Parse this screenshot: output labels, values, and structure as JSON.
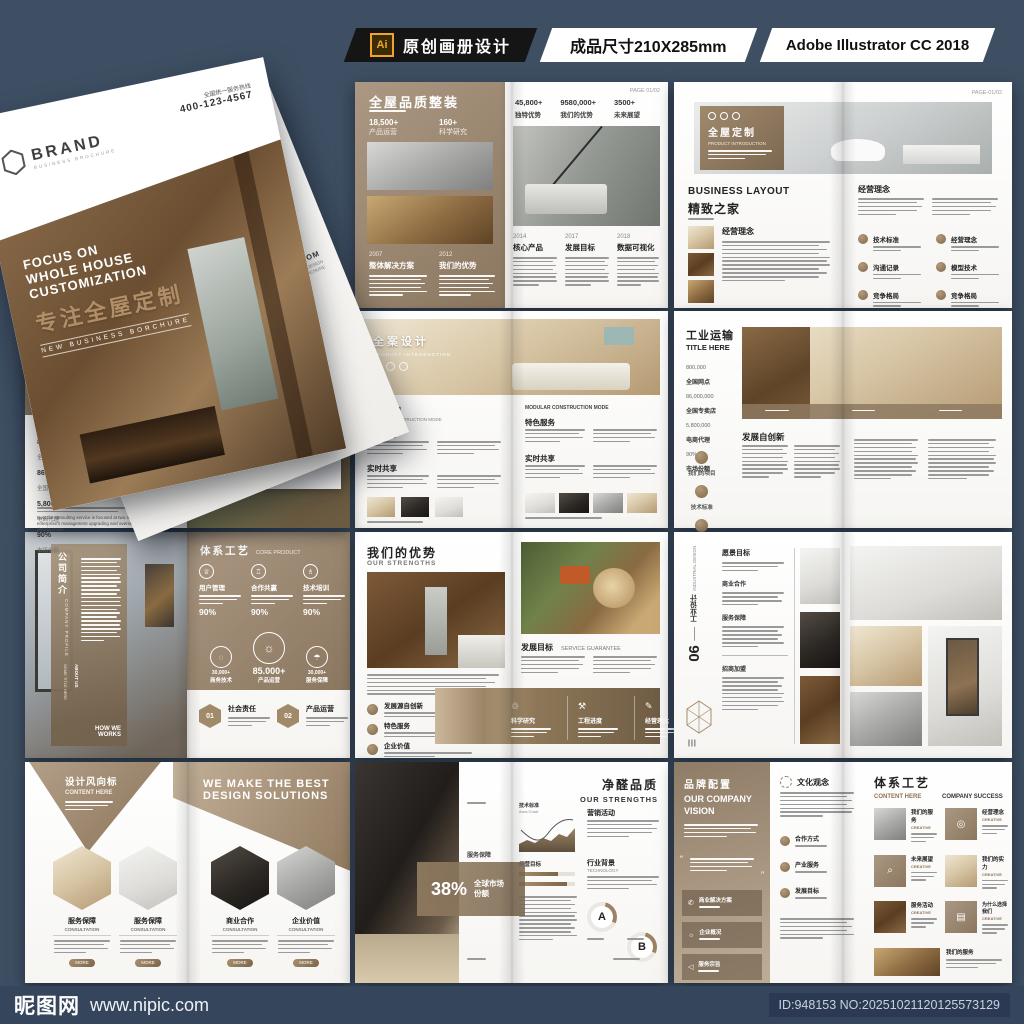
{
  "header": {
    "ai_badge": "Ai",
    "title": "原创画册设计",
    "size": "成品尺寸210X285mm",
    "software": "Adobe Illustrator CC 2018"
  },
  "footer": {
    "site": "昵图网",
    "url": "www.nipic.com",
    "id_no": "ID:948153 NO:20251021120125573129"
  },
  "cover": {
    "hotline_label": "全国统一服务热线",
    "hotline": "400-123-4567",
    "brand": "BRAND",
    "brand_sub": "BUSINESS BROCHURE",
    "headline1": "FOCUS ON",
    "headline2": "WHOLE HOUSE",
    "headline3": "CUSTOMIZATION",
    "title_cn": "专注全屋定制",
    "tagline": "NEW BUSINESS BORCHURE",
    "web": "WWW.WEB.COM",
    "web_sub1": "CREATIVE DESIGN",
    "web_sub2": "BUSINESS BORCHURE"
  },
  "s1": {
    "left": {
      "title": "全屋品质整装",
      "stats": [
        {
          "v": "18,500+",
          "l": "产品运营"
        },
        {
          "v": "160+",
          "l": "科学研究"
        }
      ],
      "years": [
        {
          "y": "2007",
          "t": "整体解决方案"
        },
        {
          "y": "2012",
          "t": "我们的优势"
        }
      ]
    },
    "right": {
      "page": "PAGE 01/02",
      "stats": [
        {
          "v": "45,800+",
          "l": "独特优势"
        },
        {
          "v": "9580,000+",
          "l": "我们的优势"
        },
        {
          "v": "3500+",
          "l": "未来展望"
        }
      ],
      "years": [
        {
          "y": "2014",
          "t": "核心产品"
        },
        {
          "y": "2017",
          "t": "发展目标"
        },
        {
          "y": "2018",
          "t": "数据可视化"
        }
      ]
    }
  },
  "s2": {
    "page": "PAGE-01/02",
    "overlay_title": "全屋定制",
    "overlay_sub": "PRODUCT INTRODUCTION",
    "left_heading_en": "BUSINESS LAYOUT",
    "left_heading_cn": "精致之家",
    "left_section": "经营理念",
    "right_section": "经营理念",
    "items": [
      "技术标准",
      "经营理念",
      "沟通记录",
      "模型技术",
      "竞争格局",
      "竞争格局"
    ]
  },
  "s3": {
    "no": "N°03",
    "title": "品牌配置",
    "menu": [
      "WORKER",
      "STUDY",
      "CASE"
    ],
    "sub_cn": "持久耐用",
    "sub_en": "DEVELOPMENT STRATEGY 2018",
    "badge": "拓展",
    "stats": [
      {
        "v": "800,000",
        "l": "全国网点"
      },
      {
        "v": "86,000,000",
        "l": "全国专卖店"
      },
      {
        "v": "5,800,000",
        "l": "电商代理"
      },
      {
        "v": "90%",
        "l": "市场份额"
      }
    ],
    "para": "Now the consulting service is focused at two sections: Local enterprise's management upgrading and overseas business development.",
    "cards": [
      {
        "t": "我们的优势"
      },
      {
        "t": "团队验收"
      }
    ]
  },
  "s4": {
    "overlay_title": "全案设计",
    "overlay_sub": "PRODUCT INTRODUCTION",
    "left_h": "精细管理",
    "left_hsub": "MODULAR CONSTRUCTION MODE",
    "sec1": "特色服务",
    "sec2": "实时共享",
    "right_top": "MODULAR CONSTRUCTION MODE",
    "rsec1": "特色服务",
    "rsec2": "实时共享"
  },
  "s5": {
    "title": "工业运输",
    "title_en": "TITLE HERE",
    "stats": [
      {
        "v": "800,000",
        "l": "全国网点"
      },
      {
        "v": "86,000,000",
        "l": "全国专卖店"
      },
      {
        "v": "5,800,000",
        "l": "电商代理"
      },
      {
        "v": "90%",
        "l": "市场份额"
      }
    ],
    "circles": [
      "我们的项目",
      "技术标准",
      "产品优势"
    ],
    "section": "发展自创新"
  },
  "s6": {
    "v_cn": "公司简介",
    "v_en": "COMPANY PROFILE",
    "about1": "ABOUT US",
    "about2": "SOME TITLE HERE",
    "how": "HOW WE WORKS",
    "r_title": "体系工艺",
    "r_title_en": "CORE PRODUCT",
    "cols": [
      {
        "l": "用户管理",
        "p": "90%"
      },
      {
        "l": "合作共赢",
        "p": "90%"
      },
      {
        "l": "技术培训",
        "p": "90%"
      }
    ],
    "circles": [
      {
        "v": "30,000+",
        "l": "商务技术"
      },
      {
        "v": "85.000+",
        "l": "产品运营"
      },
      {
        "v": "30,000+",
        "l": "服务保障"
      }
    ],
    "nums": [
      {
        "n": "01",
        "l": "社会责任"
      },
      {
        "n": "02",
        "l": "产品运营"
      }
    ]
  },
  "s7": {
    "title": "我们的优势",
    "title_en": "OUR STRENGTHS",
    "items": [
      "发展源自创新",
      "特色服务",
      "企业价值"
    ],
    "r_h": "发展目标",
    "r_hen": "SERVICE GUARANTEE",
    "band": [
      "科学研究",
      "工程进度",
      "经营理念"
    ]
  },
  "s8": {
    "num": "06",
    "side_cn": "工业设计",
    "side_en": "INDUSTRIAL DESIGN",
    "sections": [
      "愿景目标",
      "商业合作",
      "服务保障",
      "招商加盟"
    ]
  },
  "s9": {
    "lt": "设计风向标",
    "lsub": "CONTENT HERE",
    "rt1": "WE MAKE THE BEST",
    "rt2": "DESIGN SOLUTIONS",
    "hexes": [
      {
        "t": "服务保障",
        "s": "CONSULTATION"
      },
      {
        "t": "服务保障",
        "s": "CONSULTATION"
      },
      {
        "t": "商业合作",
        "s": "CONSULTATION"
      },
      {
        "t": "企业价值",
        "s": "CONSULTATION"
      }
    ],
    "more": "MORE"
  },
  "s10": {
    "pct": "38%",
    "pct_label": "全球市场份额",
    "side": "服务保障",
    "title": "净醛品质",
    "title_en": "OUR STRENGTHS",
    "c1": "技术标准",
    "c1s": "Area Chart",
    "sec1": "营销活动",
    "sec2": "经营目标",
    "sec3": "行业背景",
    "sec3s": "TECHNOLOGY",
    "ringA": "A",
    "ringB": "B"
  },
  "s11": {
    "lt": "品牌配置",
    "len1": "OUR COMPANY",
    "len2": "VISION",
    "boxes": [
      "商业解决方案",
      "企业概况",
      "服务宗旨"
    ],
    "mid_h": "文化观念",
    "mid_items": [
      "合作方式",
      "产业服务",
      "发展目标"
    ],
    "rt": "体系工艺",
    "rs1": "CONTENT HERE",
    "rs2": "COMPANY SUCCESS",
    "cells": [
      {
        "l": "我们的服务",
        "s": "CREATIVE"
      },
      {
        "l": "经营理念",
        "s": "CREATIVE"
      },
      {
        "l": "未来展望",
        "s": "CREATIVE"
      },
      {
        "l": "我们的实力",
        "s": "CREATIVE"
      },
      {
        "l": "服务活动",
        "s": "CREATIVE"
      },
      {
        "l": "为什么选择我们",
        "s": "CREATIVE"
      },
      {
        "l": "我们的服务",
        "s": "CREATIVE"
      }
    ]
  }
}
